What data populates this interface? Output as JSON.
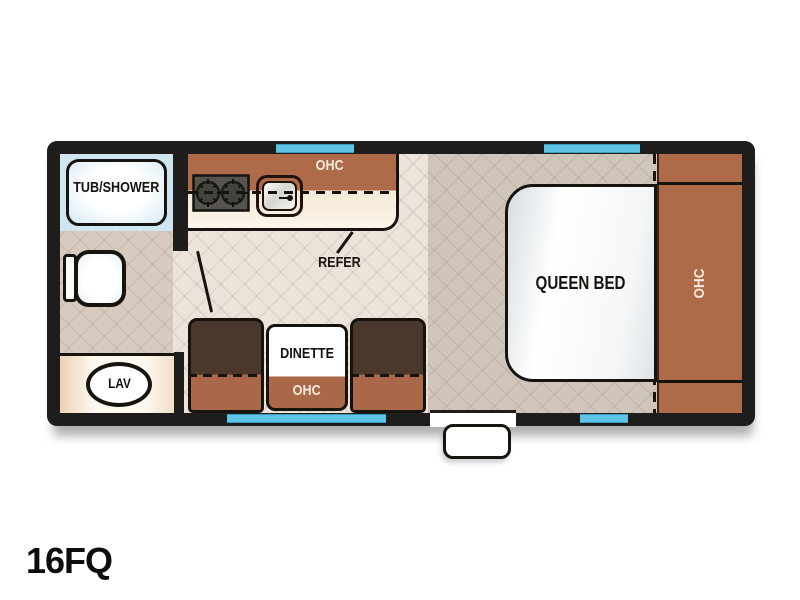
{
  "model": "16FQ",
  "floorplan": {
    "bathroom": {
      "tub_label": "TUB/SHOWER",
      "lav_label": "LAV"
    },
    "kitchen": {
      "overhead_cabinet_label": "OHC",
      "refrigerator_label": "REFER"
    },
    "dinette": {
      "table_label": "DINETTE",
      "overhead_cabinet_label": "OHC"
    },
    "bedroom": {
      "bed_label": "QUEEN BED",
      "overhead_cabinet_label": "OHC"
    }
  },
  "icons": {
    "toilet": "toilet-icon",
    "stove": "stove-burners-icon",
    "sink": "kitchen-sink-icon",
    "lav": "lavatory-sink-icon",
    "entry_step": "entry-step-icon",
    "windows": "window-strip",
    "entry_door": "entry-door-opening"
  },
  "colors": {
    "wall_black": "#1F1D1B",
    "window_blue": "#5EC3E4",
    "cabinet_brown": "#AD6B4A",
    "bench_dark_brown": "#4B382D",
    "tub_blue": "#CFE5EF",
    "living_floor": "#ECE4DA",
    "bathroom_floor": "#D8CABE",
    "bedroom_floor": "#D0C5BB"
  }
}
